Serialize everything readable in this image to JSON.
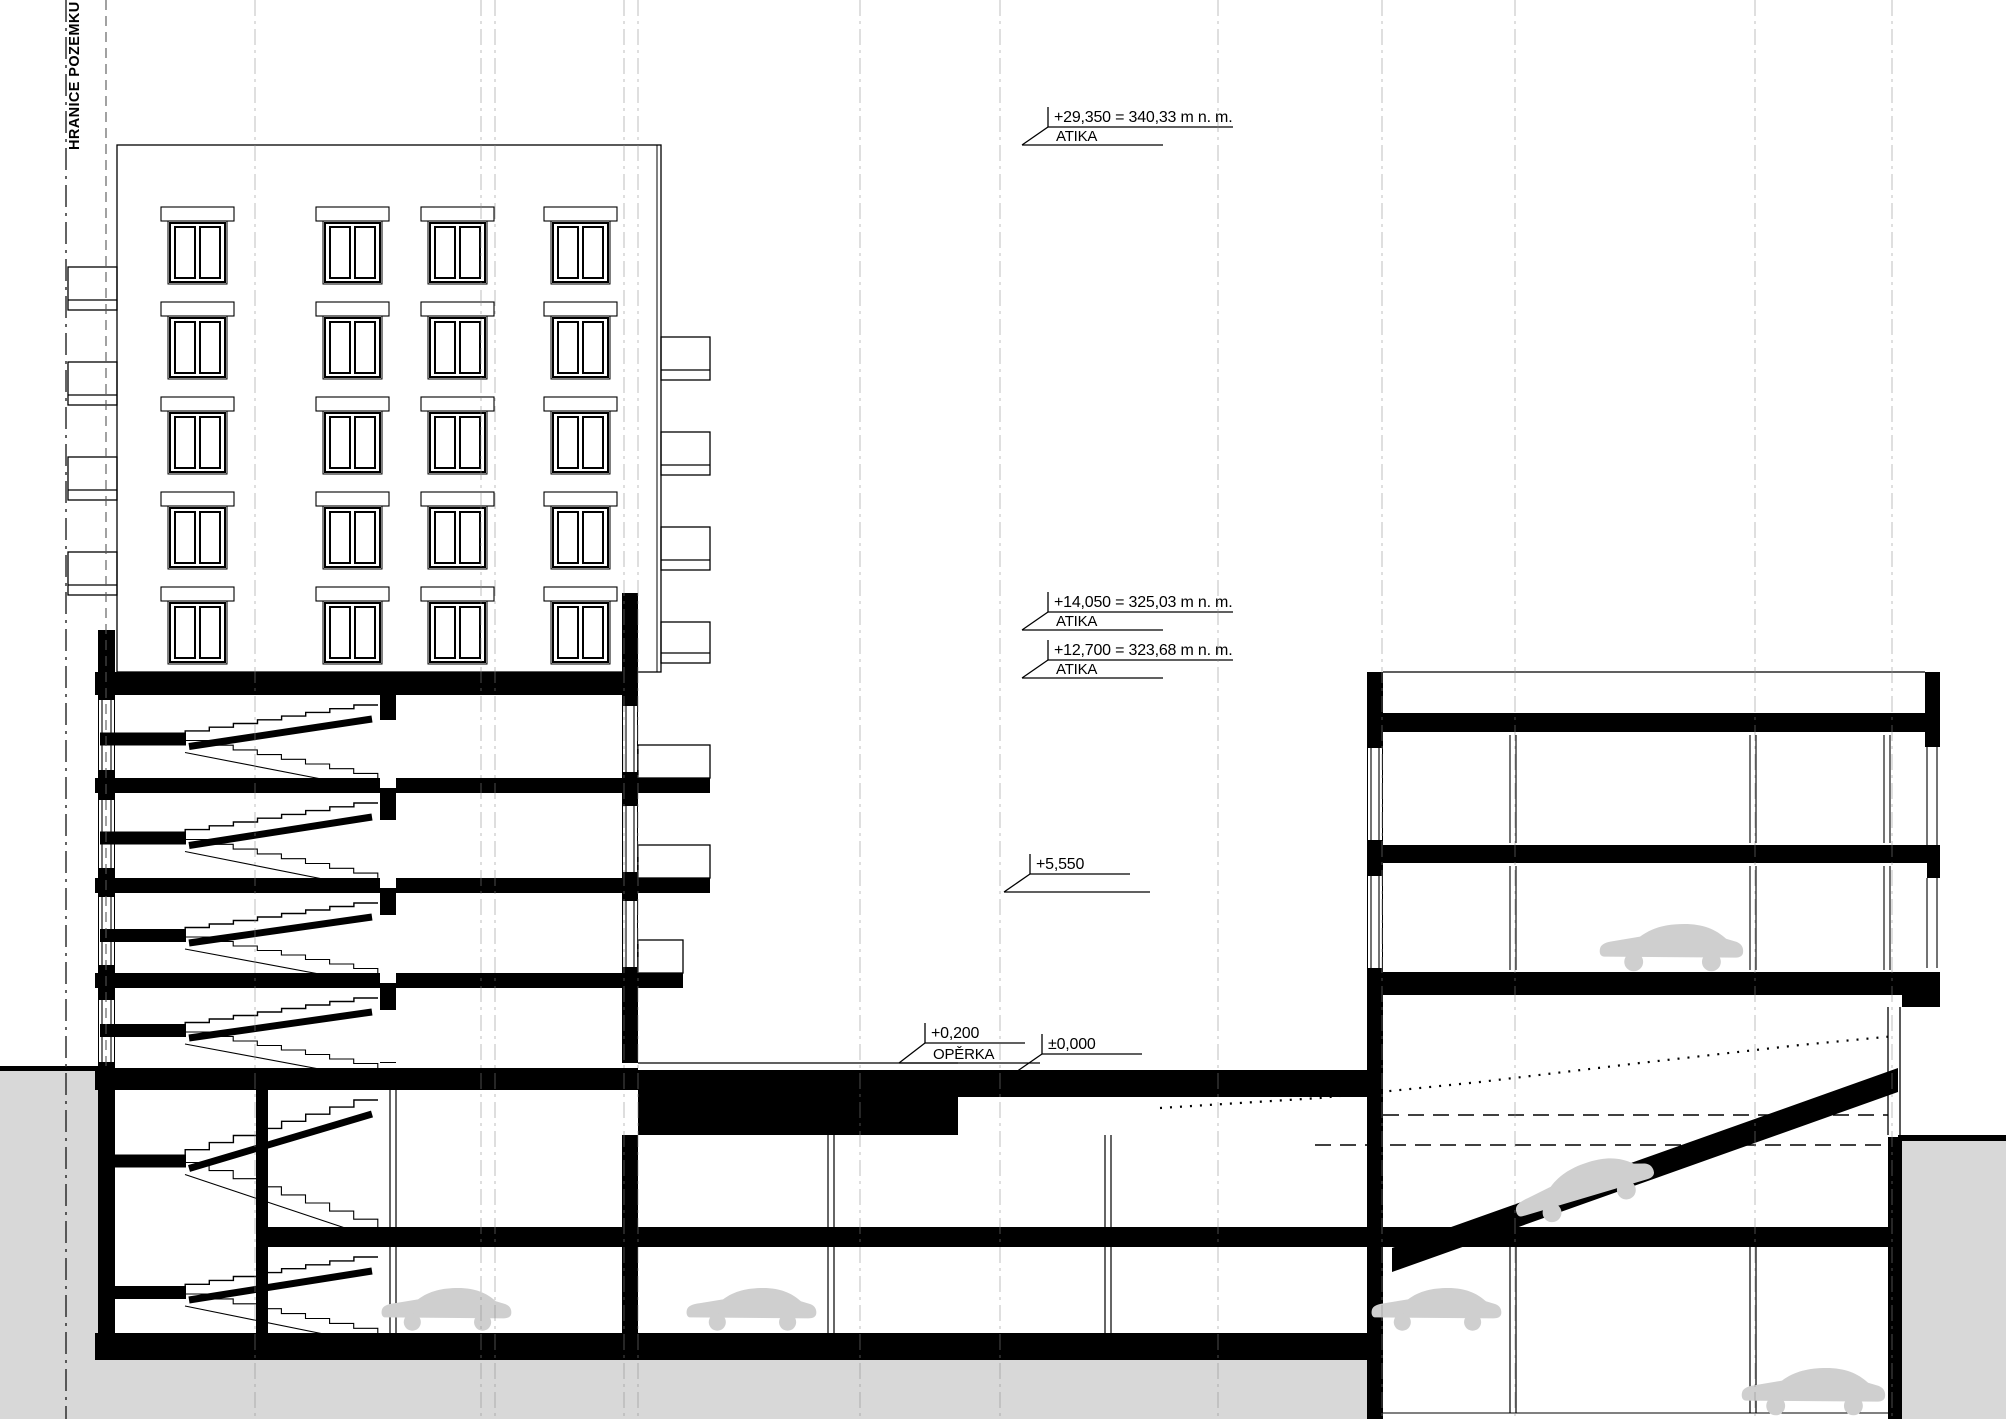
{
  "colors": {
    "paper": "#ffffff",
    "ink": "#000000",
    "terrain": "#d8d8d8",
    "car": "#cfcfcf",
    "grid": "#8a8a8a"
  },
  "boundary": {
    "label": "HRANICE POZEMKU"
  },
  "markers": [
    {
      "value": "+29,350 = 340,33 m n. m.",
      "name": "ATIKA",
      "x": 1048,
      "y_line": 127,
      "y_level": 145
    },
    {
      "value": "+14,050 = 325,03 m n. m.",
      "name": "ATIKA",
      "x": 1048,
      "y_line": 612,
      "y_level": 630
    },
    {
      "value": "+12,700 = 323,68 m n. m.",
      "name": "ATIKA",
      "x": 1048,
      "y_line": 660,
      "y_level": 678
    },
    {
      "value": "+5,550",
      "name": "",
      "x": 1030,
      "y_line": 874,
      "y_level": 892
    },
    {
      "value": "+0,200",
      "name": "OPĚRKA",
      "x": 925,
      "y_line": 1043,
      "y_level": 1063
    },
    {
      "value": "±0,000",
      "name": "",
      "x": 1042,
      "y_line": 1054,
      "y_level": 1072
    }
  ],
  "cars": [
    {
      "x": 380,
      "y": 1333,
      "s": 0.95,
      "r": 0
    },
    {
      "x": 685,
      "y": 1333,
      "s": 0.95,
      "r": 0
    },
    {
      "x": 1370,
      "y": 1333,
      "s": 0.95,
      "r": 0
    },
    {
      "x": 1740,
      "y": 1413,
      "s": 1.05,
      "r": 0
    },
    {
      "x": 1598,
      "y": 969,
      "s": 1.05,
      "r": 0
    },
    {
      "x": 1520,
      "y": 1230,
      "s": 1.05,
      "r": -17
    }
  ]
}
